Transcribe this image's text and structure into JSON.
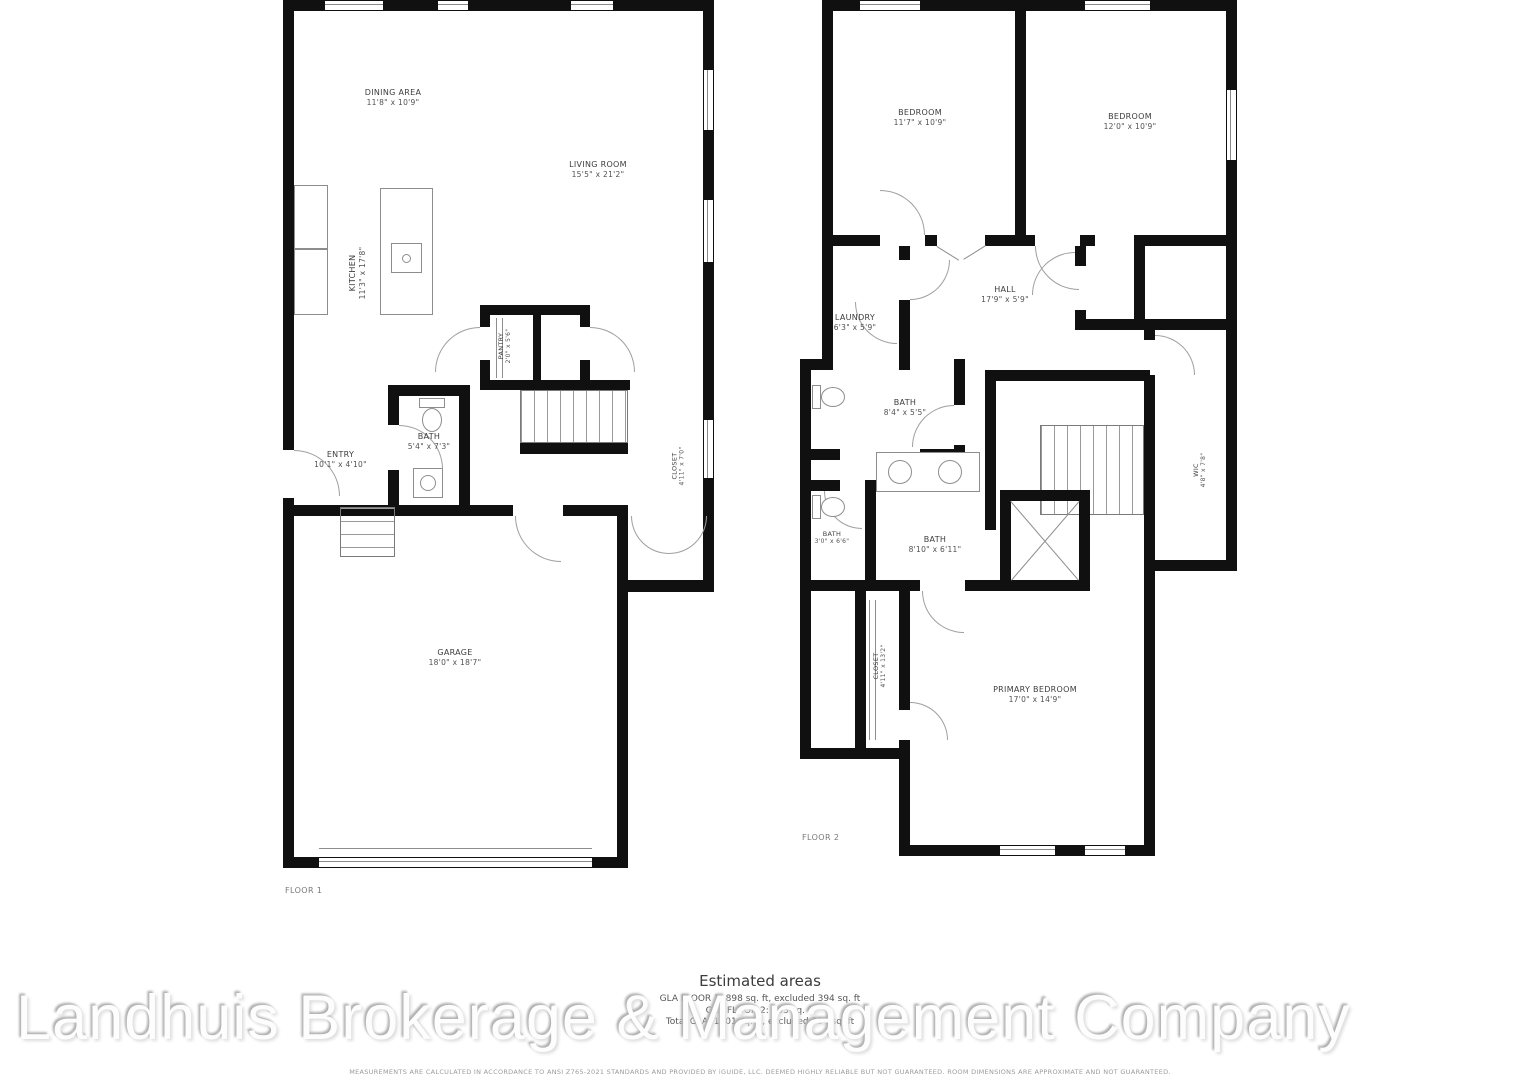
{
  "watermark": "Landhuis Brokerage & Management Company",
  "floor1": {
    "label": "FLOOR 1",
    "rooms": {
      "dining": {
        "name": "DINING AREA",
        "dims": "11'8\" x 10'9\""
      },
      "living": {
        "name": "LIVING ROOM",
        "dims": "15'5\" x 21'2\""
      },
      "kitchen": {
        "name": "KITCHEN",
        "dims": "11'3\" x 17'8\""
      },
      "pantry": {
        "name": "PANTRY",
        "dims": "2'0\" x 5'6\""
      },
      "bath": {
        "name": "BATH",
        "dims": "5'4\" x 7'3\""
      },
      "entry": {
        "name": "ENTRY",
        "dims": "10'1\" x 4'10\""
      },
      "closet": {
        "name": "CLOSET",
        "dims": "4'11\" x 7'0\""
      },
      "garage": {
        "name": "GARAGE",
        "dims": "18'0\" x 18'7\""
      }
    }
  },
  "floor2": {
    "label": "FLOOR 2",
    "rooms": {
      "bedroom1": {
        "name": "BEDROOM",
        "dims": "11'7\" x 10'9\""
      },
      "bedroom2": {
        "name": "BEDROOM",
        "dims": "12'0\" x 10'9\""
      },
      "hall": {
        "name": "HALL",
        "dims": "17'9\" x 5'9\""
      },
      "laundry": {
        "name": "LAUNDRY",
        "dims": "6'3\" x 5'9\""
      },
      "bath1": {
        "name": "BATH",
        "dims": "8'4\" x 5'5\""
      },
      "bath2": {
        "name": "BATH",
        "dims": "3'0\" x 6'6\""
      },
      "bath3": {
        "name": "BATH",
        "dims": "8'10\" x 6'11\""
      },
      "closet": {
        "name": "CLOSET",
        "dims": "4'11\" x 13'2\""
      },
      "wic": {
        "name": "WIC",
        "dims": "4'8\" x 7'8\""
      },
      "primary": {
        "name": "PRIMARY BEDROOM",
        "dims": "17'0\" x 14'9\""
      }
    }
  },
  "estimated": {
    "title": "Estimated areas",
    "lines": [
      "GLA FLOOR 1: 898 sq. ft, excluded 394 sq. ft",
      "GLA FLOOR 2: 903 sq. ft",
      "Total GLA: 1801 sq. ft, excluded 394 sq. ft"
    ],
    "disclaimer": "MEASUREMENTS ARE CALCULATED IN ACCORDANCE TO ANSI Z765-2021 STANDARDS AND PROVIDED BY iGUIDE, LLC. DEEMED HIGHLY RELIABLE BUT NOT GUARANTEED. ROOM DIMENSIONS ARE APPROXIMATE AND NOT GUARANTEED."
  }
}
